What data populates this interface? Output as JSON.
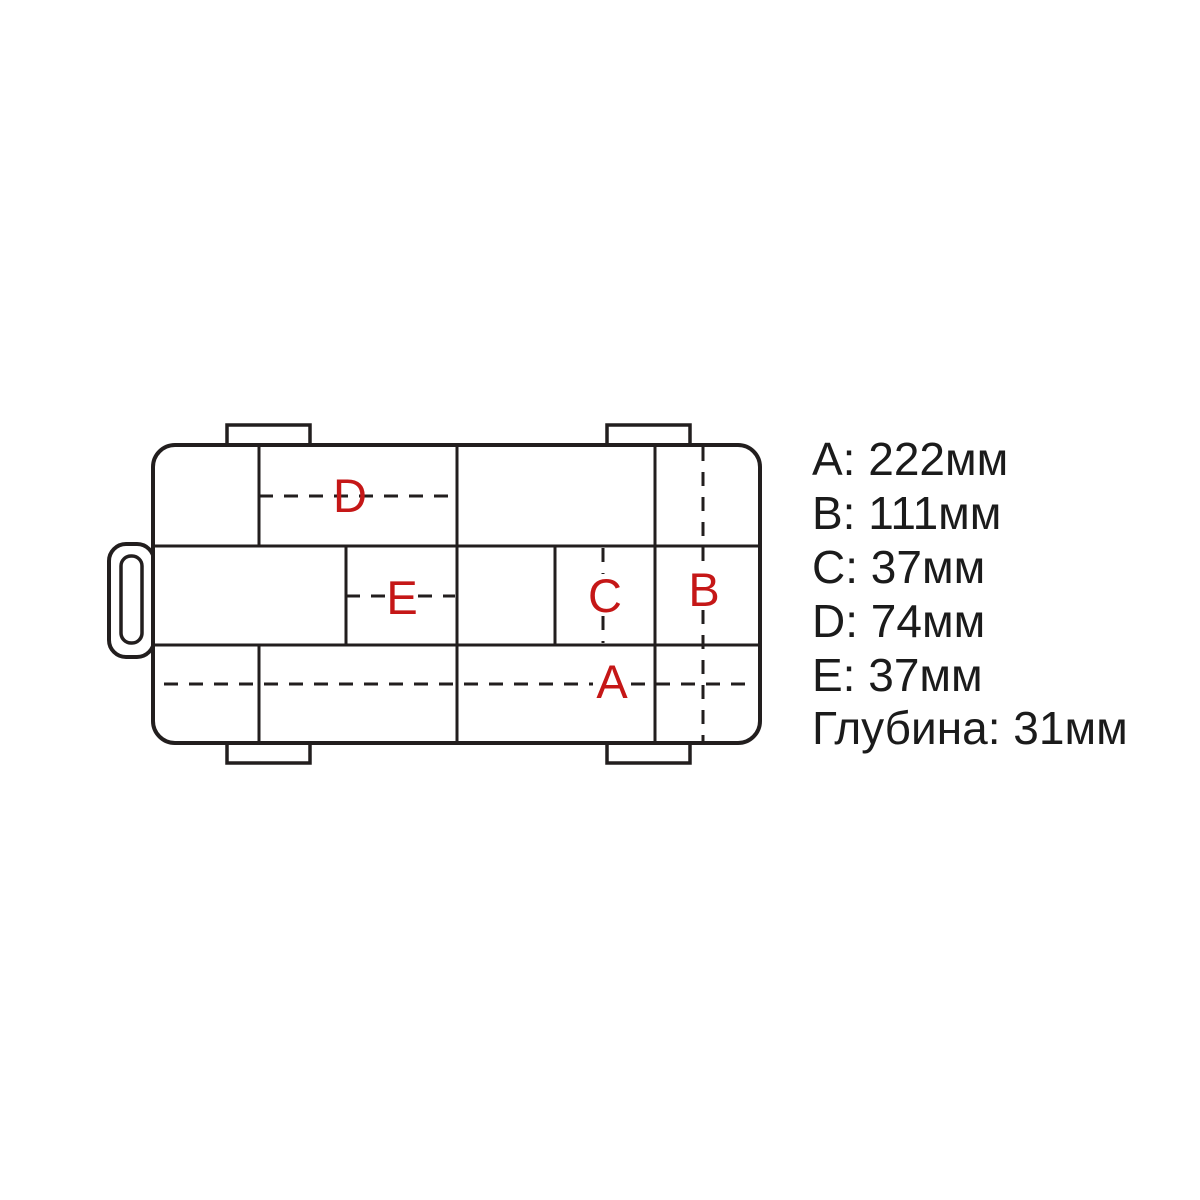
{
  "diagram": {
    "type": "tackle-box-compartment-layout-top-view",
    "line_color": "#221e1e",
    "marker_color": "#c51717",
    "markers": [
      {
        "letter": "A"
      },
      {
        "letter": "B"
      },
      {
        "letter": "C"
      },
      {
        "letter": "D"
      },
      {
        "letter": "E"
      }
    ]
  },
  "legend": {
    "text_color": "#1b1b1b",
    "items": [
      {
        "label": "A",
        "value_mm": 222,
        "unit": "мм",
        "text": "A: 222мм"
      },
      {
        "label": "B",
        "value_mm": 111,
        "unit": "мм",
        "text": "B: 111мм"
      },
      {
        "label": "C",
        "value_mm": 37,
        "unit": "мм",
        "text": "C: 37мм"
      },
      {
        "label": "D",
        "value_mm": 74,
        "unit": "мм",
        "text": "D: 74мм"
      },
      {
        "label": "E",
        "value_mm": 37,
        "unit": "мм",
        "text": "E: 37мм"
      },
      {
        "label": "Глубина",
        "value_mm": 31,
        "unit": "мм",
        "text": "Глубина: 31мм"
      }
    ]
  }
}
